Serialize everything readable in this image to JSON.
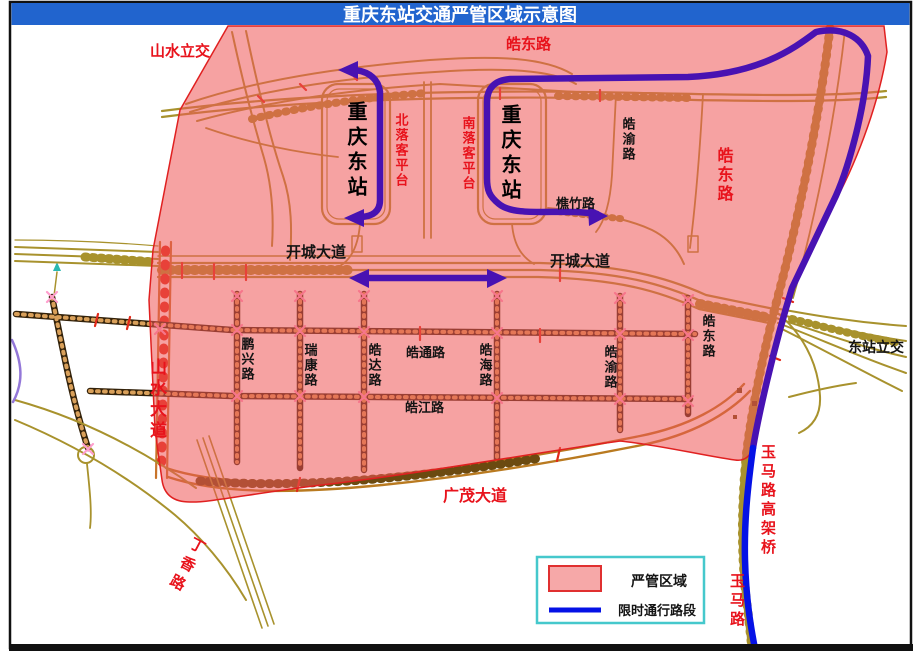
{
  "title": "重庆东站交通严管区域示意图",
  "legend": {
    "items": [
      {
        "label": "严管区域",
        "swatch": "pink-area-swatch"
      },
      {
        "label": "限时通行路段",
        "swatch": "blue-line-swatch"
      }
    ]
  },
  "roads": {
    "shanshui_lijiao": "山水立交",
    "haodong_top": "皓东路",
    "bei_luoke_pingtai": "北落客平台",
    "nan_luoke_pingtai": "南落客平台",
    "station_left": "重庆东站",
    "station_right": "重庆东站",
    "haoyu_top": "皓渝路",
    "haodong_right": "皓东路",
    "qiaozhu_lu": "樵竹路",
    "kaicheng_dadao_left": "开城大道",
    "kaicheng_dadao_right": "开城大道",
    "pengxing_lu": "鹏兴路",
    "ruikang_lu": "瑞康路",
    "haoda_lu": "皓达路",
    "haotong_lu": "皓通路",
    "haohai_lu": "皓海路",
    "haojiang_lu": "皓江路",
    "haoyu_lower": "皓渝路",
    "haodong_lower": "皓东路",
    "dongzhan_lijiao": "东站立交",
    "shanshui_dadao": "山水大道",
    "guangmao_dadao": "广茂大道",
    "dingxiang_lu": "丁香路",
    "yuma_gaojiaqiao": "玉马路高架桥",
    "yuma_lu": "玉马路"
  },
  "colors": {
    "title_bar_blue": "#2164ce",
    "title_text": "#ffffff",
    "region_fill_apparent": "#f5a3a3",
    "region_border": "#e02020",
    "route_blue": "#0512e6",
    "route_purple_inside_region": "#4812b2",
    "road_orange": "#ce7043",
    "road_olive": "#a8922d",
    "grid_road_dark": "#33220a",
    "label_red": "#e8131c",
    "legend_border_cyan": "#45c8cc"
  }
}
